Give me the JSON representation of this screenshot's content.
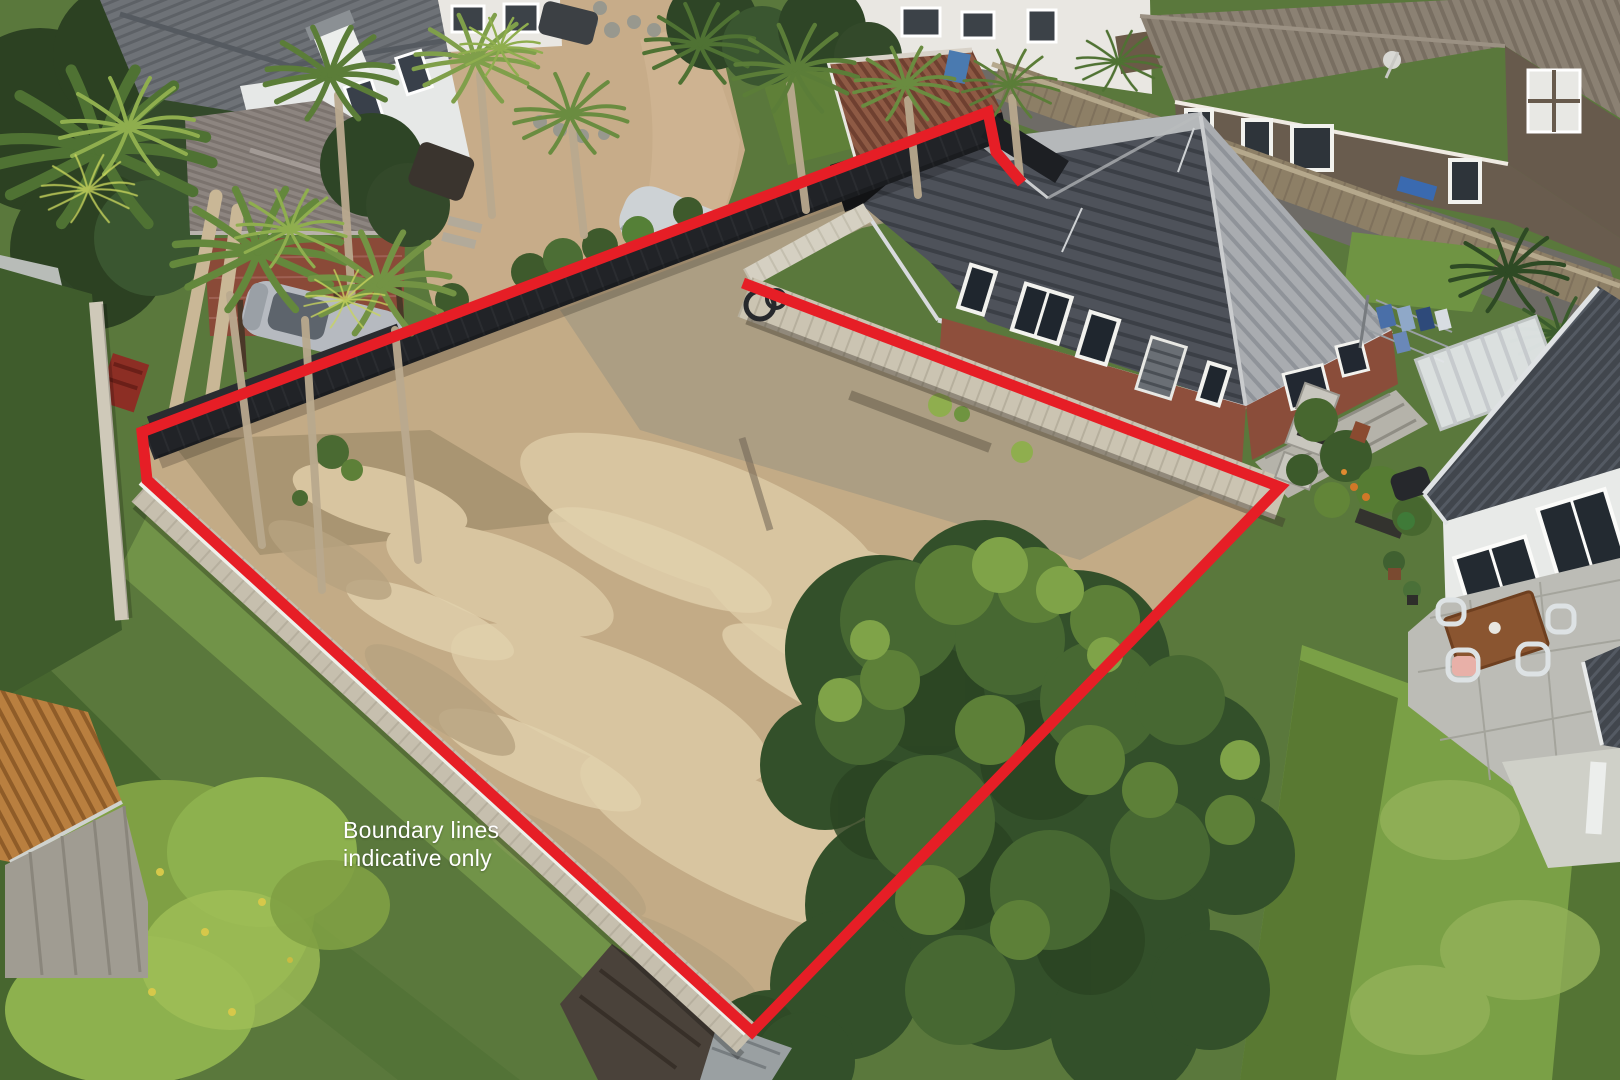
{
  "annotation": {
    "line1": "Boundary lines",
    "line2": "indicative only",
    "text_color": "#ffffff"
  },
  "boundary": {
    "color": "#e61e26",
    "stroke_width_px": 11,
    "path": "M1022,183 L996,152 L988,112 L142,432 L147,480 L752,1032 L1280,487 L743,283"
  },
  "scene": {
    "description": "aerial drone photo of a cleared vacant residential section outlined with a red boundary overlay",
    "palette": {
      "lawn": "#5a783c",
      "lawn_bright": "#7aa046",
      "dirt": "#c3ab86",
      "dirt_light": "#d8c5a0",
      "dirt_dark": "#a89b82",
      "black_fence": "#212327",
      "timber_fence": "#c6bfae",
      "brick_wall": "#8e4f3c",
      "roof_dark": "#4e525a",
      "roof_light": "#a8acb0",
      "shed_roof_rust": "#8e5a44",
      "small_shed_roof_orange": "#b97f3f",
      "driveway_concrete": "#c7ac89"
    },
    "objects": [
      "vacant-dirt-lot",
      "red-boundary-overlay",
      "black-timber-fence",
      "light-timber-retaining-fence",
      "new-paling-fence",
      "neighbour-house-grey-roof",
      "brick-house-grey-tile-roof",
      "brown-two-storey-house",
      "white-weatherboard-house",
      "rusty-roof-shed",
      "small-orange-roof-shed",
      "palm-trees",
      "tree-ferns",
      "large-bushy-trees",
      "concrete-driveway",
      "silver-car-under-carport",
      "car-under-silver-cover",
      "white-pergola",
      "outdoor-dining-table",
      "white-chairs",
      "paved-patio",
      "green-lawns",
      "long-grass-patch",
      "clothesline-with-washing",
      "garden-shrubs"
    ]
  }
}
